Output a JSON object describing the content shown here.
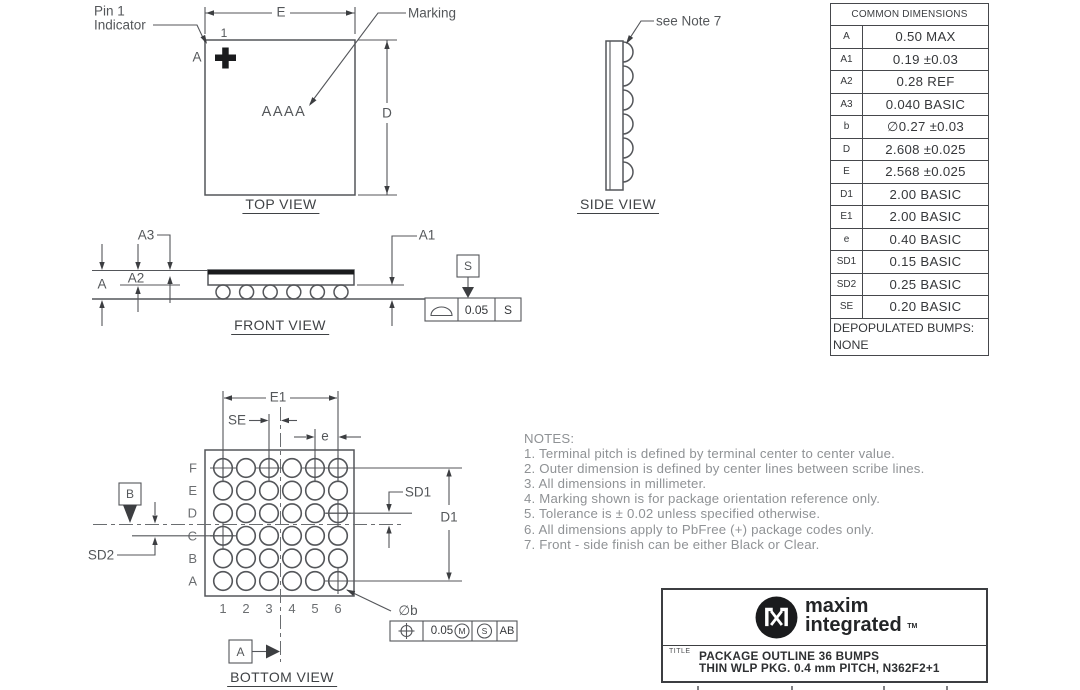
{
  "colors": {
    "line": "#54565a",
    "text": "#3e4043",
    "label": "#54575a",
    "muted": "#8f9295",
    "black": "#1a1b1d"
  },
  "views": {
    "top": {
      "title": "TOP VIEW",
      "pin1_line1": "Pin 1",
      "pin1_line2": "Indicator",
      "pin1_ball": "1",
      "pin1_row": "A",
      "marking_label": "Marking",
      "marking_text": "AAAA",
      "dim_e": "E",
      "dim_d": "D"
    },
    "side": {
      "title": "SIDE VIEW",
      "note": "see Note 7"
    },
    "front": {
      "title": "FRONT VIEW",
      "dim_a": "A",
      "dim_a1": "A1",
      "dim_a2": "A2",
      "dim_a3": "A3",
      "datum": "S",
      "flatness_value": "0.05",
      "flatness_datum": "S"
    },
    "bottom": {
      "title": "BOTTOM VIEW",
      "dim_e1": "E1",
      "dim_se": "SE",
      "dim_e": "e",
      "dim_d1": "D1",
      "dim_sd1": "SD1",
      "dim_sd2": "SD2",
      "dim_b": "∅b",
      "datum_a": "A",
      "datum_b": "B",
      "row_labels": [
        "F",
        "E",
        "D",
        "C",
        "B",
        "A"
      ],
      "col_labels": [
        "1",
        "2",
        "3",
        "4",
        "5",
        "6"
      ],
      "cross_bumps": [
        "F1",
        "F3",
        "F5",
        "F6",
        "D6",
        "C1",
        "A6"
      ],
      "position_fcf": {
        "value": "0.05",
        "mod_m": "M",
        "mod_s": "S",
        "datums": "AB"
      }
    }
  },
  "notes": {
    "title": "NOTES:",
    "items": [
      "1. Terminal pitch is defined by terminal center to center value.",
      "2. Outer dimension is defined by center lines between scribe lines.",
      "3. All dimensions in millimeter.",
      "4. Marking shown is for package orientation reference only.",
      "5. Tolerance is ± 0.02 unless specified otherwise.",
      "6. All dimensions apply to PbFree (+) package codes only.",
      "7. Front - side finish can be either Black or Clear."
    ]
  },
  "table": {
    "title": "COMMON DIMENSIONS",
    "rows": [
      {
        "name": "A",
        "value": "0.50 MAX"
      },
      {
        "name": "A1",
        "value": "0.19 ±0.03"
      },
      {
        "name": "A2",
        "value": "0.28 REF"
      },
      {
        "name": "A3",
        "value": "0.040 BASIC"
      },
      {
        "name": "b",
        "value": "∅0.27 ±0.03"
      },
      {
        "name": "D",
        "value": "2.608 ±0.025"
      },
      {
        "name": "E",
        "value": "2.568 ±0.025"
      },
      {
        "name": "D1",
        "value": "2.00 BASIC"
      },
      {
        "name": "E1",
        "value": "2.00 BASIC"
      },
      {
        "name": "e",
        "value": "0.40 BASIC"
      },
      {
        "name": "SD1",
        "value": "0.15 BASIC"
      },
      {
        "name": "SD2",
        "value": "0.25 BASIC"
      },
      {
        "name": "SE",
        "value": "0.20 BASIC"
      }
    ],
    "footer_line1": "DEPOPULATED BUMPS:",
    "footer_line2": "NONE"
  },
  "title_block": {
    "brand_top": "maxim",
    "brand_bottom": "integrated",
    "trademark": "TM",
    "field_label": "TITLE",
    "line1": "PACKAGE OUTLINE 36 BUMPS",
    "line2": "THIN WLP PKG. 0.4 mm PITCH, N362F2+1"
  }
}
